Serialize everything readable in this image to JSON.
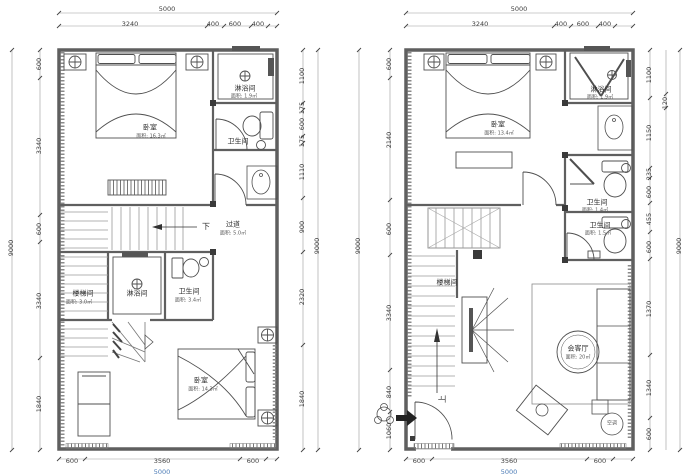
{
  "left": {
    "dims": {
      "top_total": "5000",
      "top_segs": [
        "3240",
        "400",
        "600",
        "400"
      ],
      "left_outer": "9000",
      "left_chain": [
        "600",
        "3340",
        "600",
        "3340",
        "1840"
      ],
      "right_chain": [
        "1100",
        "175",
        "600",
        "175",
        "1110",
        "900",
        "2320",
        "1840"
      ],
      "right_outer": "9000",
      "bottom_segs": [
        "600",
        "3560",
        "600"
      ],
      "bottom_total": "5000"
    },
    "rooms": {
      "bedroom_top": {
        "name": "卧室",
        "area": "面积: 16.3㎡"
      },
      "shower_top": {
        "name": "淋浴间",
        "area": "面积: 1.9㎡"
      },
      "toilet_top": {
        "name": "卫生间"
      },
      "down_label": "下",
      "corridor": {
        "name": "过道",
        "area": "面积: 5.0㎡"
      },
      "stair_room": {
        "name": "楼梯间",
        "area": "面积: 3.0㎡"
      },
      "shower_mid": {
        "name": "淋浴间"
      },
      "toilet_mid": {
        "name": "卫生间",
        "area": "面积: 3.4㎡"
      },
      "bedroom_bottom": {
        "name": "卧室",
        "area": "面积: 14.3㎡"
      }
    }
  },
  "right": {
    "dims": {
      "top_total": "5000",
      "top_segs": [
        "3240",
        "400",
        "600",
        "400"
      ],
      "left_outer": "9000",
      "left_chain": [
        "600",
        "2140",
        "600",
        "3340",
        "840",
        "1060"
      ],
      "right_chain": [
        "1100",
        "1150",
        "235",
        "600",
        "455",
        "600",
        "1370",
        "1340",
        "600"
      ],
      "right_upper_outer": "120",
      "right_outer": "9000",
      "bottom_segs": [
        "600",
        "3560",
        "600"
      ],
      "bottom_total": "5000"
    },
    "rooms": {
      "bedroom": {
        "name": "卧室",
        "area": "面积: 13.4㎡"
      },
      "shower": {
        "name": "淋浴间",
        "area": "面积: 1.9㎡"
      },
      "toilet_upper": {
        "name": "卫生间",
        "area": "面积: 1.4㎡"
      },
      "toilet_lower": {
        "name": "卫生间",
        "area": "面积: 1.5㎡"
      },
      "stair_room": {
        "name": "楼梯间"
      },
      "living": {
        "name": "会客厅",
        "area": "面积: 20㎡"
      },
      "up_label": "上",
      "ac_label": "空调"
    }
  }
}
